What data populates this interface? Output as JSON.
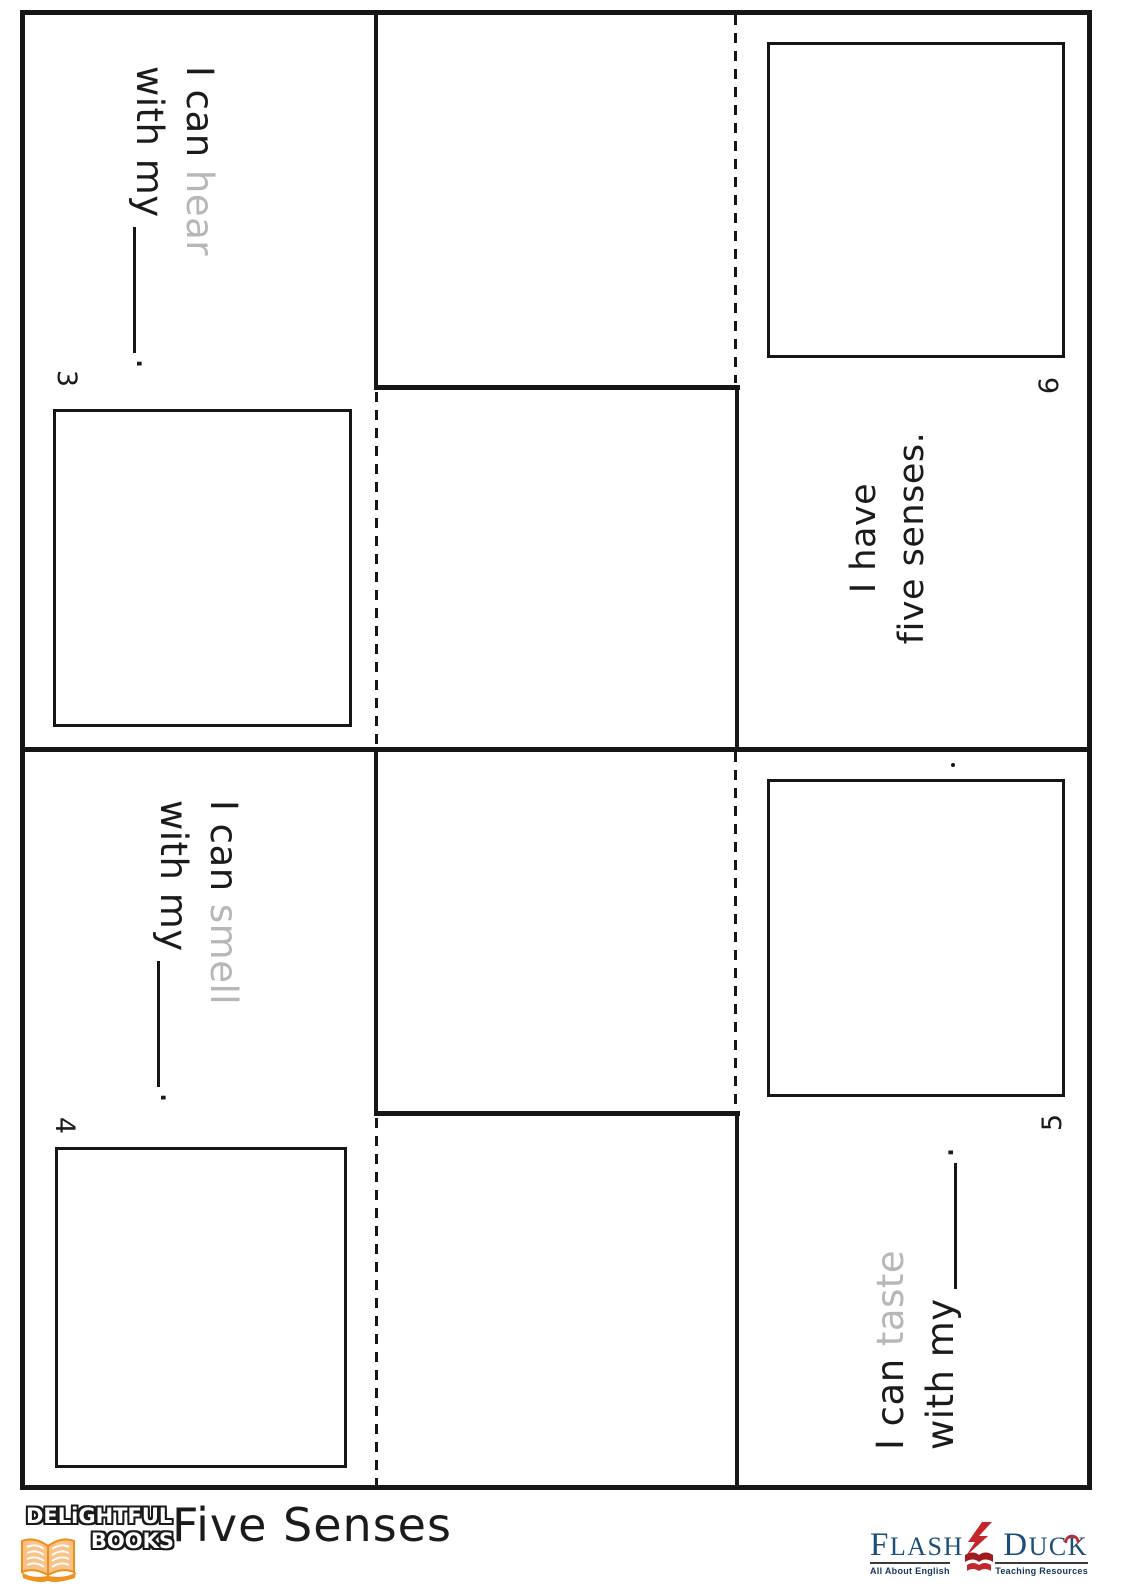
{
  "pages": [
    {
      "number": "3",
      "line1_start": "I can",
      "trace_word": "hear",
      "line2_start": "with my",
      "end_mark": "."
    },
    {
      "number": "4",
      "line1_start": "I can",
      "trace_word": "smell",
      "line2_start": "with my",
      "end_mark": "."
    },
    {
      "number": "5",
      "line1_start": "I can",
      "trace_word": "taste",
      "line2_start": "with my",
      "end_mark": "."
    },
    {
      "number": "6",
      "line1": "I have",
      "line2": "five senses."
    }
  ],
  "footer": {
    "publisher": {
      "line1": "DELiGHTFUL",
      "line2": "BOOKS"
    },
    "worksheet_title": "Five Senses",
    "brand": {
      "name_left": "FLASH",
      "name_right": "DUCK",
      "tagline_left": "All About English",
      "tagline_right": "Teaching Resources"
    }
  },
  "colors": {
    "ink": "#161616",
    "trace_gray": "#b7b7b7",
    "brand_navy": "#1c4e79",
    "brand_red": "#c1272d",
    "book_orange": "#f0921e",
    "book_peach": "#fac287"
  }
}
